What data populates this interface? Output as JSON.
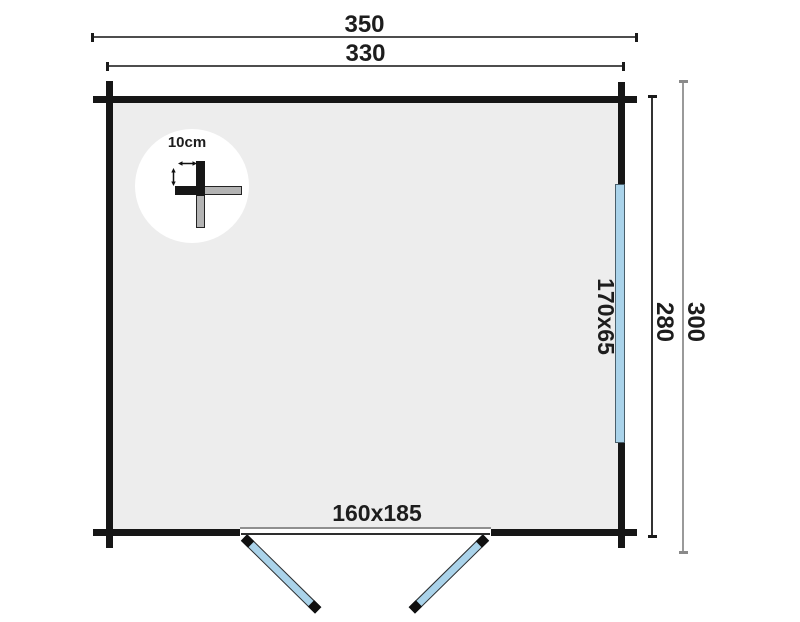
{
  "plan": {
    "dimensions": {
      "overall_width": "350",
      "inner_width": "330",
      "overall_depth": "300",
      "inner_depth": "280"
    },
    "window": {
      "label": "170x65"
    },
    "door": {
      "label": "160x185"
    },
    "corner_detail": {
      "label": "10cm"
    },
    "colors": {
      "wall": "#161616",
      "interior_fill": "#ededed",
      "glazing_blue": "#aad3ea",
      "dim_line_dark": "#4d4d4d",
      "dim_line_gray": "#9a9a9a",
      "plank_gray": "#b3b3b3"
    }
  }
}
